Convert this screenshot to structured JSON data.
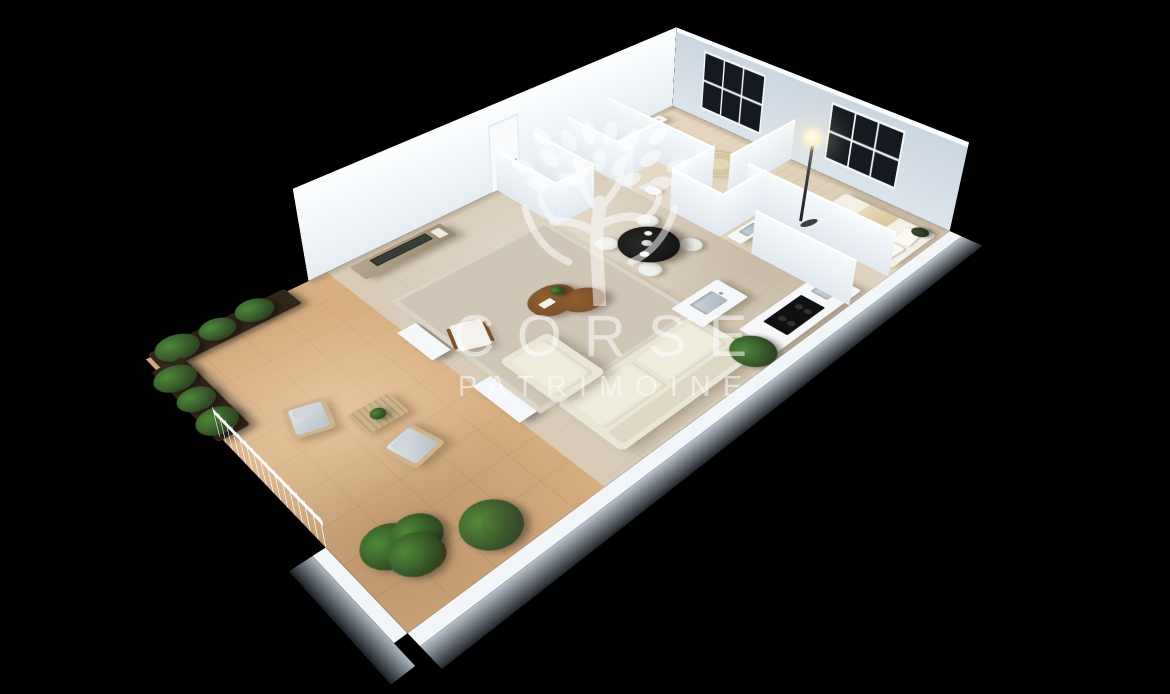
{
  "meta": {
    "type": "3d-floor-plan-render",
    "description": "Isometric 3D render of a furnished apartment with terrace on black background"
  },
  "watermark": {
    "logo": "olive-tree-icon",
    "brand_line1": "CORSE",
    "brand_line2": "PATRIMOINE"
  },
  "theme": {
    "background": "#000000",
    "wall_lit": "#f1f4f7",
    "wall_shade": "#ccd6e0",
    "wall_top": "#fafcfe",
    "floor_tile": "#d8ccb9",
    "floor_terrace": "#d6ae82",
    "rug": "#cfc6b6",
    "sofa": "#e9e6d6",
    "wood_dark": "#7c4f2b",
    "wood_light": "#cdb48e",
    "green_dark": "#2e4522",
    "green_light": "#4e8a3a",
    "table_black": "#151515",
    "chair_white": "#eef0ea",
    "planter": "#33261a",
    "window_pane": "#141a20",
    "watermark": "rgba(255,255,255,0.52)"
  },
  "rooms": [
    {
      "name": "terrace",
      "furniture": [
        "hedge-planters",
        "outdoor-armchair",
        "outdoor-armchair",
        "slatted-coffee-table",
        "potted-ficus",
        "potted-palm",
        "railing"
      ]
    },
    {
      "name": "living-room",
      "furniture": [
        "tv-sideboard",
        "tv",
        "lounge-chair",
        "organic-coffee-table",
        "area-rug",
        "sofa",
        "chaise"
      ]
    },
    {
      "name": "kitchen-dining",
      "furniture": [
        "round-dining-table",
        "dining-chairs",
        "flower-vase",
        "island-with-sink",
        "counter-with-hob",
        "potted-palm"
      ]
    },
    {
      "name": "hallway",
      "furniture": [
        "entrance-door"
      ]
    },
    {
      "name": "laundry-wc",
      "furniture": [
        "washing-machine",
        "linen-shelves",
        "toilet"
      ]
    },
    {
      "name": "bathroom",
      "furniture": [
        "vanity-sink"
      ]
    },
    {
      "name": "bedroom-1",
      "furniture": [
        "double-bed",
        "nightstand",
        "round-rug",
        "floor-lamp",
        "french-window"
      ]
    },
    {
      "name": "bedroom-2",
      "furniture": [
        "double-bed",
        "open-wardrobe",
        "pouf",
        "window"
      ]
    }
  ]
}
